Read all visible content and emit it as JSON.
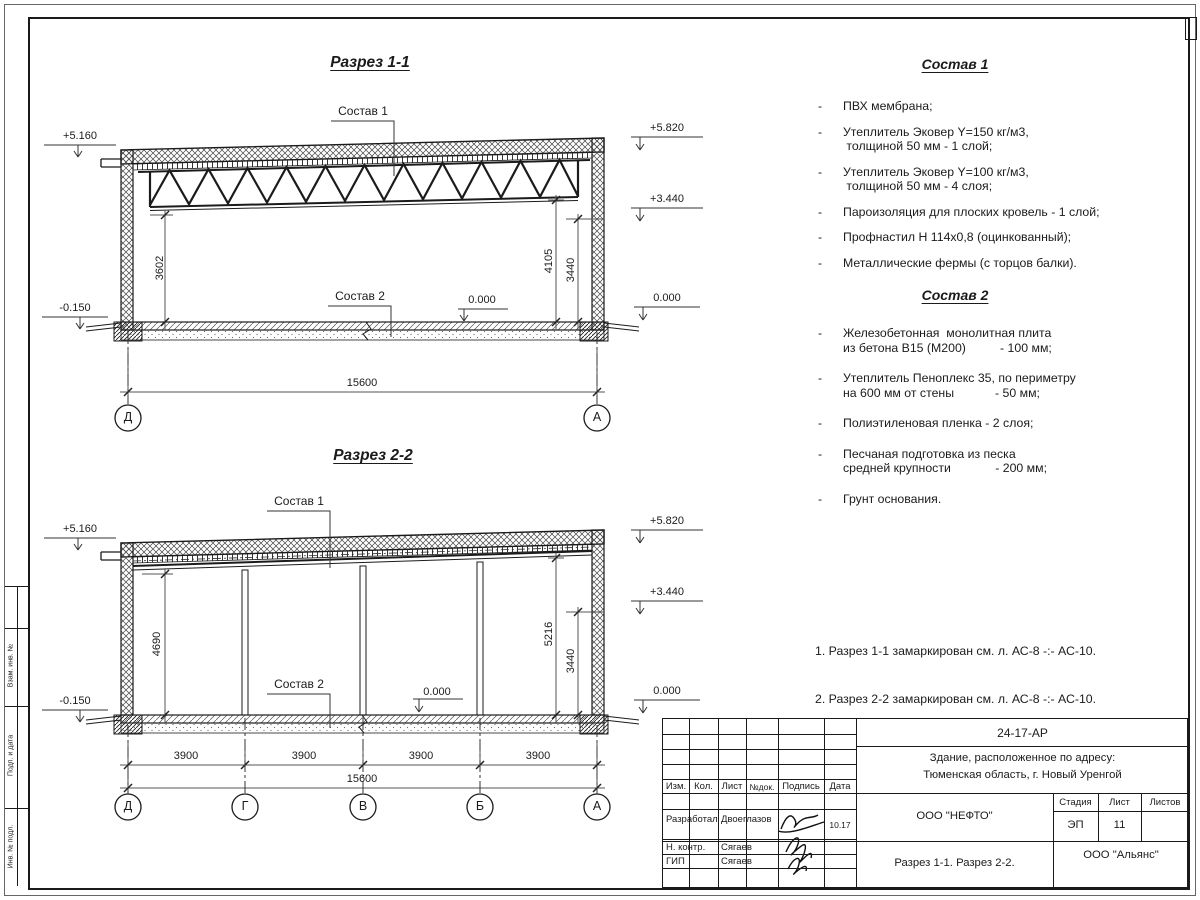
{
  "s1": {
    "title": "Разрез 1-1",
    "sostav1_label": "Состав 1",
    "sostav2_label": "Состав 2",
    "elev_left_top": "+5.160",
    "elev_right_top": "+5.820",
    "elev_right_mid": "+3.440",
    "elev_right_zero": "0.000",
    "elev_floor_zero": "0.000",
    "elev_left_base": "-0.150",
    "dim_left": "3602",
    "dim_right_inner": "4105",
    "dim_right_outer": "3440",
    "dim_total": "15600",
    "axes": [
      "Д",
      "А"
    ]
  },
  "s2": {
    "title": "Разрез 2-2",
    "sostav1_label": "Состав 1",
    "sostav2_label": "Состав 2",
    "elev_left_top": "+5.160",
    "elev_right_top": "+5.820",
    "elev_right_mid": "+3.440",
    "elev_right_zero": "0.000",
    "elev_floor_zero": "0.000",
    "elev_left_base": "-0.150",
    "dim_left": "4690",
    "dim_right_inner": "5216",
    "dim_right_outer": "3440",
    "dim_spans": [
      "3900",
      "3900",
      "3900",
      "3900"
    ],
    "dim_total": "15600",
    "axes": [
      "Д",
      "Г",
      "В",
      "Б",
      "А"
    ]
  },
  "right_panel": {
    "bullet": "-",
    "sostav1_heading": "Состав 1",
    "sostav1_items": [
      {
        "line1": "ПВХ мембрана;"
      },
      {
        "line1": "Утеплитель Эковер Y=150 кг/м3,",
        "line2": " толщиной 50 мм - 1 слой;"
      },
      {
        "line1": "Утеплитель Эковер Y=100 кг/м3,",
        "line2": " толщиной 50 мм - 4 слоя;"
      },
      {
        "line1": "Пароизоляция для плоских кровель - 1 слой;"
      },
      {
        "line1": "Профнастил Н 114х0,8 (оцинкованный);"
      },
      {
        "line1": "Металлические фермы (с торцов балки)."
      }
    ],
    "sostav2_heading": "Состав 2",
    "sostav2_items": [
      {
        "line1": "Железобетонная  монолитная плита",
        "line2": "из бетона В15 (М200)          - 100 мм;"
      },
      {
        "line1": "Утеплитель Пеноплекс 35, по периметру",
        "line2": "на 600 мм от стены            - 50 мм;"
      },
      {
        "line1": "Полиэтиленовая пленка - 2 слоя;"
      },
      {
        "line1": "Песчаная подготовка из песка",
        "line2": "средней крупности             - 200 мм;"
      },
      {
        "line1": "Грунт основания."
      }
    ],
    "notes_line1": "1. Разрез 1-1 замаркирован см. л. АС-8 -:- АС-10.",
    "notes_line2": "2. Разрез 2-2 замаркирован см. л. АС-8 -:- АС-10."
  },
  "titleblock": {
    "doc_number": "24-17-АР",
    "project_line1": "Здание, расположенное по адресу:",
    "project_line2": "Тюменская область, г. Новый Уренгой",
    "org": "ООО \"НЕФТО\"",
    "headers": {
      "izm": "Изм.",
      "kol": "Кол.",
      "list": "Лист",
      "ndok": "№док.",
      "podpis": "Подпись",
      "data": "Дата",
      "stadia": "Стадия",
      "sheet": "Лист",
      "sheets": "Листов"
    },
    "rows": [
      {
        "role": "Разработал",
        "name": "Двоеглазов",
        "date": "10.17"
      },
      {
        "role": "Н. контр.",
        "name": "Сягаев"
      },
      {
        "role": "ГИП",
        "name": "Сягаев"
      }
    ],
    "stadia_value": "ЭП",
    "sheet_value": "11",
    "sheets_value": "",
    "sheet_title": "Разрез 1-1. Разрез 2-2.",
    "company": "ООО \"Альянс\""
  },
  "frame": {
    "side_labels": [
      "Взам. инв. №",
      "Подп. и дата",
      "Инв. № подл."
    ]
  }
}
